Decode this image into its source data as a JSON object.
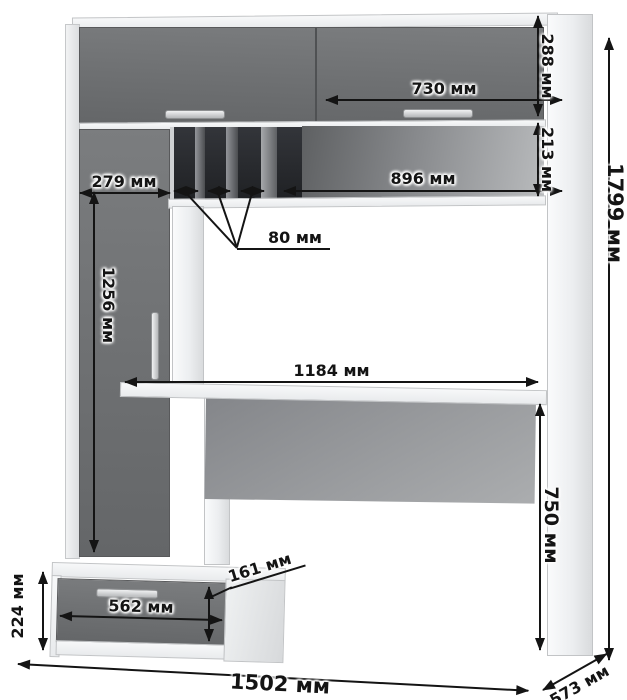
{
  "unit": "мм",
  "colors": {
    "front_panels": "#6e7072",
    "carcass": "#f1f2f3",
    "shelf_interior_dark": "#26282a",
    "modesty_panel": "#989a9c",
    "annotation": "#141414"
  },
  "dimensions": {
    "top_door_width": {
      "label": "730 мм",
      "value": 730
    },
    "top_door_height": {
      "label": "288 мм",
      "value": 288
    },
    "niche_height": {
      "label": "213 мм",
      "value": 213
    },
    "niche_width": {
      "label": "896 мм",
      "value": 896
    },
    "left_column_width": {
      "label": "279 мм",
      "value": 279
    },
    "cd_slot_width": {
      "label": "80 мм",
      "value": 80
    },
    "tall_door_height": {
      "label": "1256 мм",
      "value": 1256
    },
    "desktop_width": {
      "label": "1184 мм",
      "value": 1184
    },
    "desktop_height": {
      "label": "750 мм",
      "value": 750
    },
    "total_height": {
      "label": "1799 мм",
      "value": 1799
    },
    "pedestal_height": {
      "label": "224 мм",
      "value": 224
    },
    "drawer_width": {
      "label": "562 мм",
      "value": 562
    },
    "drawer_front_height": {
      "label": "161 мм",
      "value": 161
    },
    "total_width": {
      "label": "1502 мм",
      "value": 1502
    },
    "total_depth": {
      "label": "573 мм",
      "value": 573
    }
  }
}
